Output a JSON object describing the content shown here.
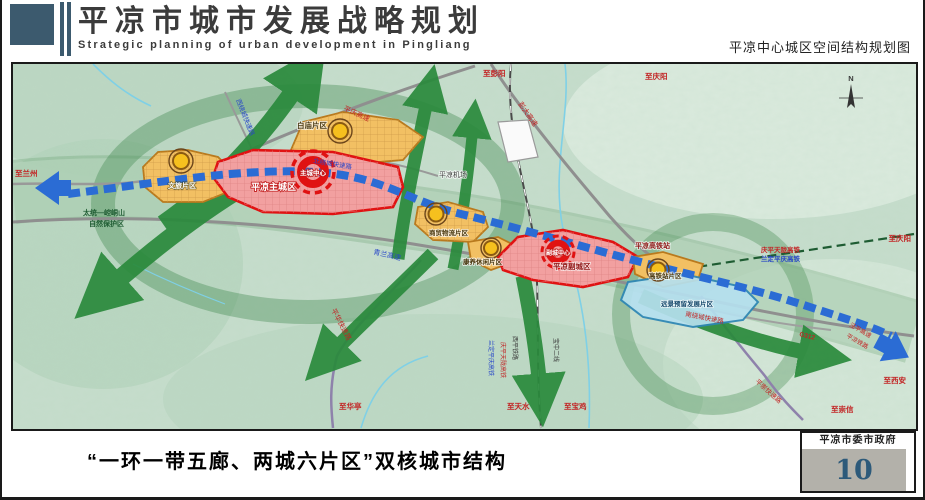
{
  "header": {
    "title": "平凉市城市发展战略规划",
    "subtitle": "Strategic planning of urban development in Pingliang",
    "right_caption": "平凉中心城区空间结构规划图"
  },
  "footer": {
    "caption": "“一环一带五廊、两城六片区”双核城市结构",
    "authority": "平凉市委市政府",
    "page_number": "10"
  },
  "colors": {
    "brand_slate": "#3c5a6e",
    "eco_green": "#2a8a3c",
    "axis_blue": "#2b6cd4",
    "city_red": "#e01212",
    "district_orange": "#f2c063",
    "reserve_cyan": "#b5e0ef",
    "page_number_navy": "#2d5a7a"
  },
  "map": {
    "labels": {
      "to_lanzhou": "至兰州",
      "west_ring_road": "西绕城快速路",
      "pingqing_expwy": "平庆高速",
      "north_ring_road": "北绕城快速路",
      "pengda_expwy": "彭大高速",
      "to_pengyang": "至彭阳",
      "to_qingyang_north": "至庆阳",
      "baimiao_district": "白庙片区",
      "airport": "平凉机场",
      "main_city": "平凉主城区",
      "main_center": "主城中心",
      "wenlv_district": "文旅片区",
      "qinglan_expwy": "青兰高速",
      "trade_logistics_district": "商贸物流片区",
      "leisure_district": "康养休闲片区",
      "sub_city": "平凉副城区",
      "sub_center": "副城中心",
      "hsr_station": "平凉高铁站",
      "qingping_tianlong_hsr": "庆平天陇高铁",
      "landing_pingqing_hsr": "兰定平庆高铁",
      "to_qingyang_east": "至庆阳",
      "hsr_district": "高铁站片区",
      "reserve_district": "远景预留发展片区",
      "nature_reserve_1": "太统—崆峒山",
      "nature_reserve_2": "自然保护区",
      "pinghua_expwy": "平华快速路",
      "to_huating": "至华亭",
      "landing_pingqing_hsr_v": "兰定平庆高铁",
      "qingping_tianlong_hsr_v": "庆平天陇高铁",
      "xiping_railway": "西平铁路",
      "baozhong_line2": "宝中二线",
      "to_tianshui": "至天水",
      "to_baoji": "至宝鸡",
      "south_ring_road": "南绕城快速路",
      "g312": "G312",
      "jingping_expwy": "泾平高速",
      "pingliang_railway": "平凉铁路",
      "to_xian": "至西安",
      "pingchong_expwy": "平崇快速路",
      "to_chongxin": "至崇信",
      "compass_n": "N"
    }
  }
}
